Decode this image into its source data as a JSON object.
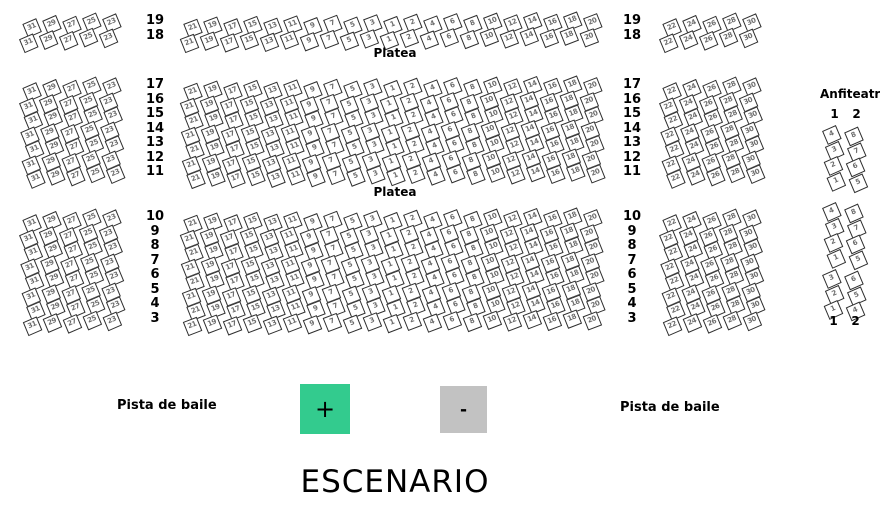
{
  "stage": {
    "label": "ESCENARIO"
  },
  "platea": {
    "label_top": "Platea",
    "label_middle": "Platea"
  },
  "dance_floor": {
    "label_left": "Pista de baile",
    "label_right": "Pista de baile"
  },
  "zoom_controls": {
    "zoom_in": "+",
    "zoom_out": "-"
  },
  "colors": {
    "seat_border": "#2f2f2f",
    "seat_number": "#6e6e6e",
    "zoom_in_bg": "#33cb8e",
    "zoom_out_bg": "#c2c2c2",
    "text": "#000000"
  },
  "seating": {
    "blocks": {
      "left": [
        31,
        29,
        27,
        25,
        23
      ],
      "center": [
        21,
        19,
        17,
        15,
        13,
        11,
        9,
        7,
        5,
        3,
        1,
        2,
        4,
        6,
        8,
        10,
        12,
        14,
        16,
        18,
        20
      ],
      "right": [
        22,
        24,
        26,
        28,
        30
      ]
    },
    "sections": [
      {
        "name": "top",
        "rows": [
          19,
          18
        ]
      },
      {
        "name": "middle",
        "rows": [
          17,
          16,
          15,
          14,
          13,
          12,
          11
        ]
      },
      {
        "name": "bottom",
        "rows": [
          10,
          9,
          8,
          7,
          6,
          5,
          4,
          3
        ]
      }
    ]
  },
  "anfiteatro": {
    "title": "Anfiteatro",
    "column_labels": [
      "1",
      "2"
    ],
    "groups": [
      {
        "columns": [
          [
            4,
            3,
            2,
            1
          ],
          [
            8,
            7,
            6,
            5
          ]
        ]
      },
      {
        "columns": [
          [
            4,
            3,
            2,
            1
          ],
          [
            8,
            7,
            6,
            5
          ]
        ]
      },
      {
        "columns": [
          [
            3,
            2,
            1
          ],
          [
            6,
            5,
            4
          ]
        ]
      }
    ]
  }
}
